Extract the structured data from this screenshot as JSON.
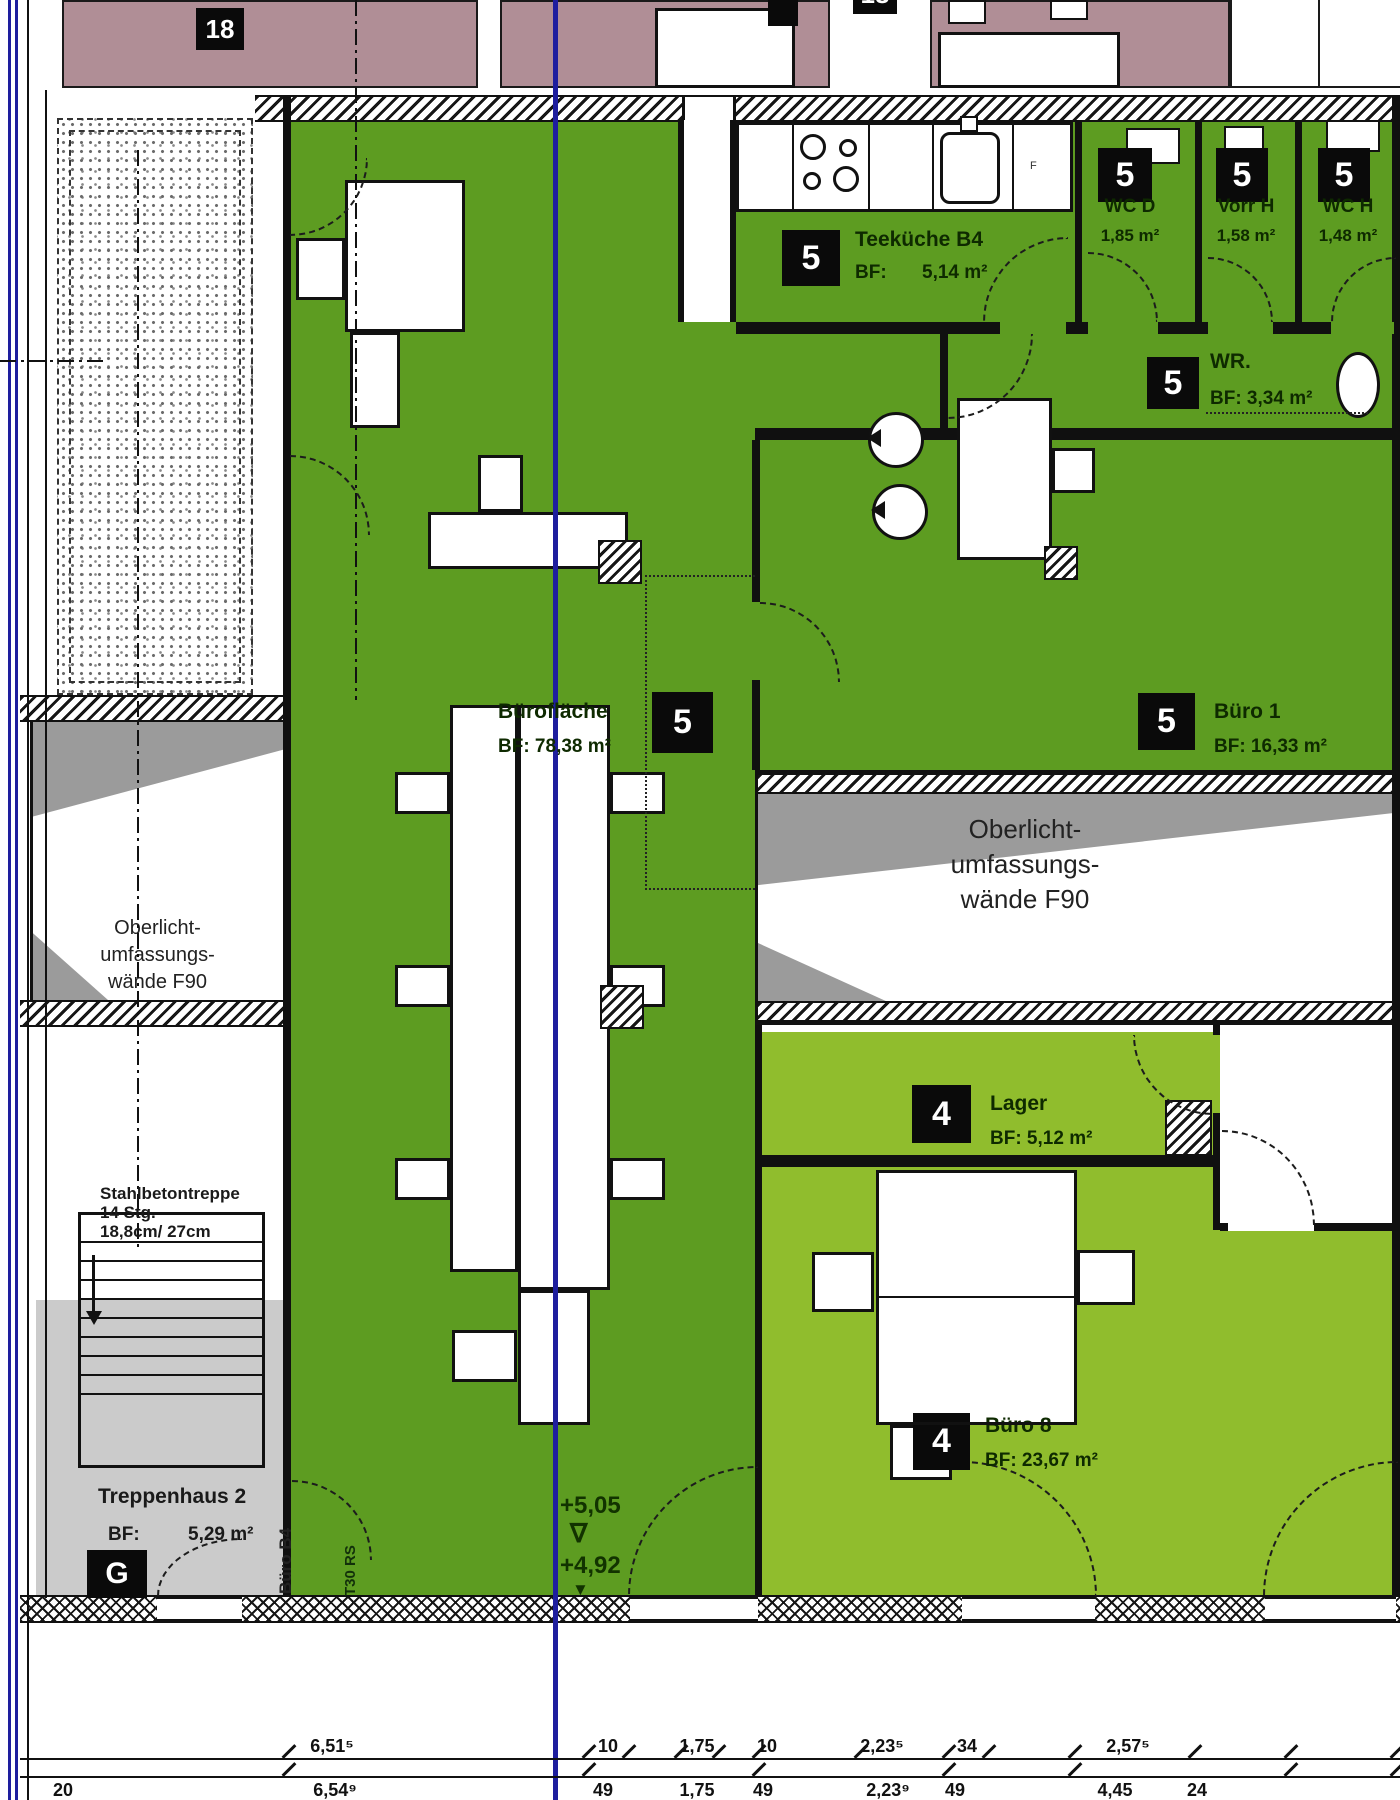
{
  "top": {
    "building_label_left": "18",
    "building_label_right": "18"
  },
  "rooms": {
    "teekueche": {
      "no": "5",
      "name": "Teeküche B4",
      "bf": "BF:",
      "area": "5,14 m²"
    },
    "wc_d": {
      "no": "5",
      "name": "WC D",
      "area": "1,85 m²"
    },
    "vorr_h": {
      "no": "5",
      "name": "Vorr H",
      "area": "1,58 m²"
    },
    "wc_h": {
      "no": "5",
      "name": "WC H",
      "area": "1,48 m²"
    },
    "wr": {
      "no": "5",
      "name": "WR.",
      "area": "BF: 3,34 m²"
    },
    "buero1": {
      "no": "5",
      "name": "Büro 1",
      "area": "BF: 16,33 m²"
    },
    "bueroflaeche": {
      "no": "5",
      "name": "Bürofläche",
      "area": "BF: 78,38 m²"
    },
    "lager": {
      "no": "4",
      "name": "Lager",
      "area": "BF: 5,12 m²"
    },
    "buero8": {
      "no": "4",
      "name": "Büro 8",
      "area": "BF: 23,67 m²"
    },
    "treppenhaus": {
      "no": "G",
      "name": "Treppenhaus 2",
      "bf": "BF:",
      "area": "5,29 m²"
    }
  },
  "oberlicht": {
    "line1": "Oberlicht-",
    "line2": "umfassungs-",
    "line3": "wände F90"
  },
  "stair": {
    "note1": "Stahlbetontreppe",
    "note2": "14 Stg.",
    "note3": "18,8cm/ 27cm"
  },
  "tags": {
    "door": "T30 RS",
    "room_ref": "Büro B4",
    "shaft": "F"
  },
  "levels": {
    "upper": "+5,05",
    "nabla": "∇",
    "lower": "+4,92",
    "arrow": "▼"
  },
  "dimensions": {
    "row1": [
      "6,51⁵",
      "10",
      "1,75",
      "10",
      "2,23⁵",
      "34",
      "2,57⁵"
    ],
    "row2": [
      "20",
      "6,54⁹",
      "49",
      "1,75",
      "49",
      "2,23⁹",
      "49",
      "4,45",
      "24"
    ]
  },
  "colors": {
    "office_green": "#5d9c21",
    "light_green": "#90bd2d",
    "mauve": "#b08e96",
    "section_blue": "#1e1e9e",
    "stair_gray": "#cbcbcb"
  }
}
